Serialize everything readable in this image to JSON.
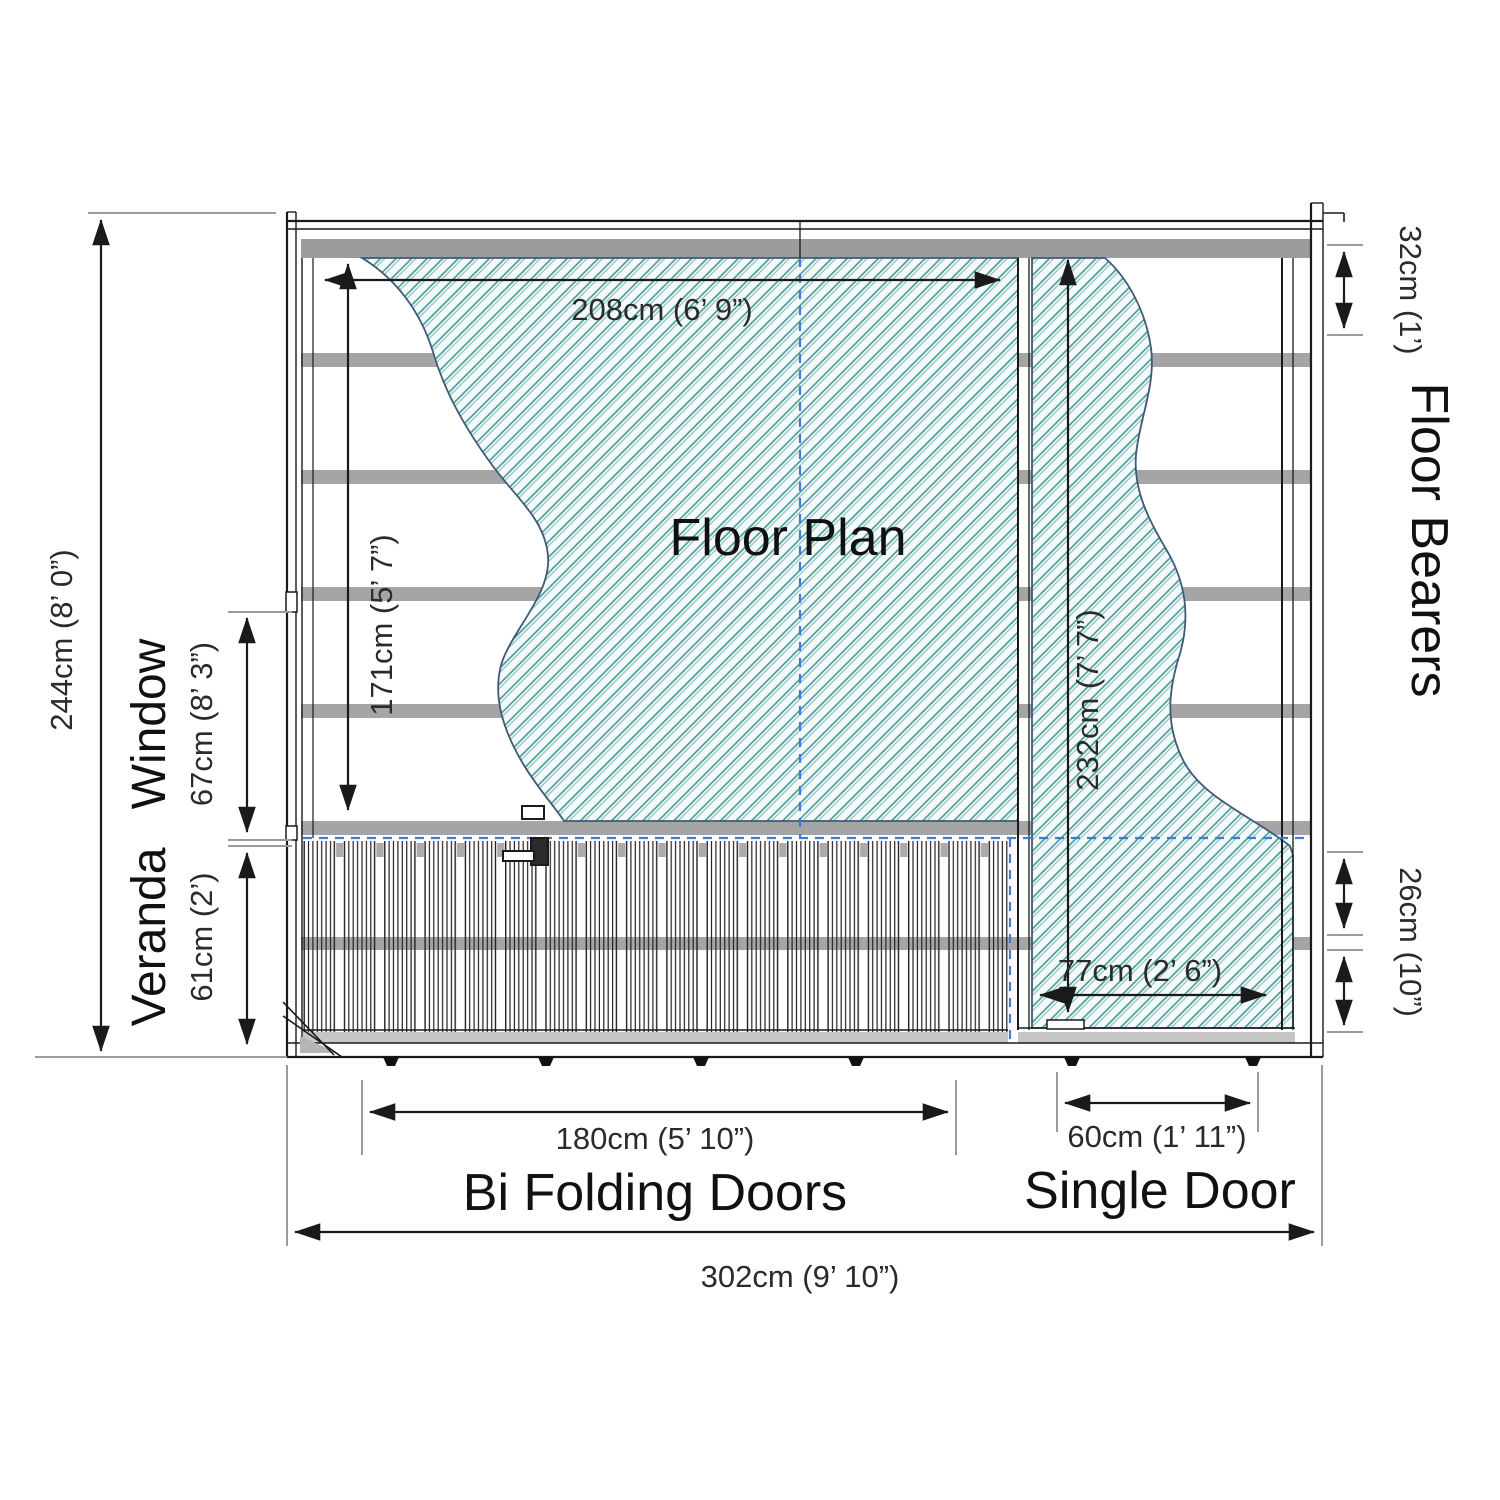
{
  "title": "Floor Plan",
  "labels": {
    "floor_plan": "Floor Plan",
    "window": "Window",
    "veranda": "Veranda",
    "floor_bearers": "Floor Bearers",
    "bi_folding_doors": "Bi Folding Doors",
    "single_door": "Single Door"
  },
  "dims": {
    "total_width": "302cm (9’ 10”)",
    "total_height": "244cm (8’ 0”)",
    "interior_width": "208cm (6’ 9”)",
    "interior_height": "171cm (5’ 7”)",
    "right_section_height": "232cm (7’ 7”)",
    "door_clear_width": "77cm (2’ 6”)",
    "window_height": "67cm (8’ 3”)",
    "veranda_depth": "61cm (2’)",
    "bearer_spacing": "32cm (1’)",
    "bearer_spacing_small": "26cm (10”)",
    "bifold_width": "180cm (5’ 10”)",
    "single_door_width": "60cm (1’ 11”)"
  },
  "colors": {
    "hatch_teal": "#4f9d9c",
    "hatch_bg": "#f4fafa",
    "bearer_gray": "#a5a5a5",
    "sill_gray": "#c6c6c6",
    "dashed_blue": "#3b7cd6",
    "blob_outline": "#3f5a77",
    "tick_gray": "#9b9b9b",
    "line_black": "#1a1a1a"
  }
}
